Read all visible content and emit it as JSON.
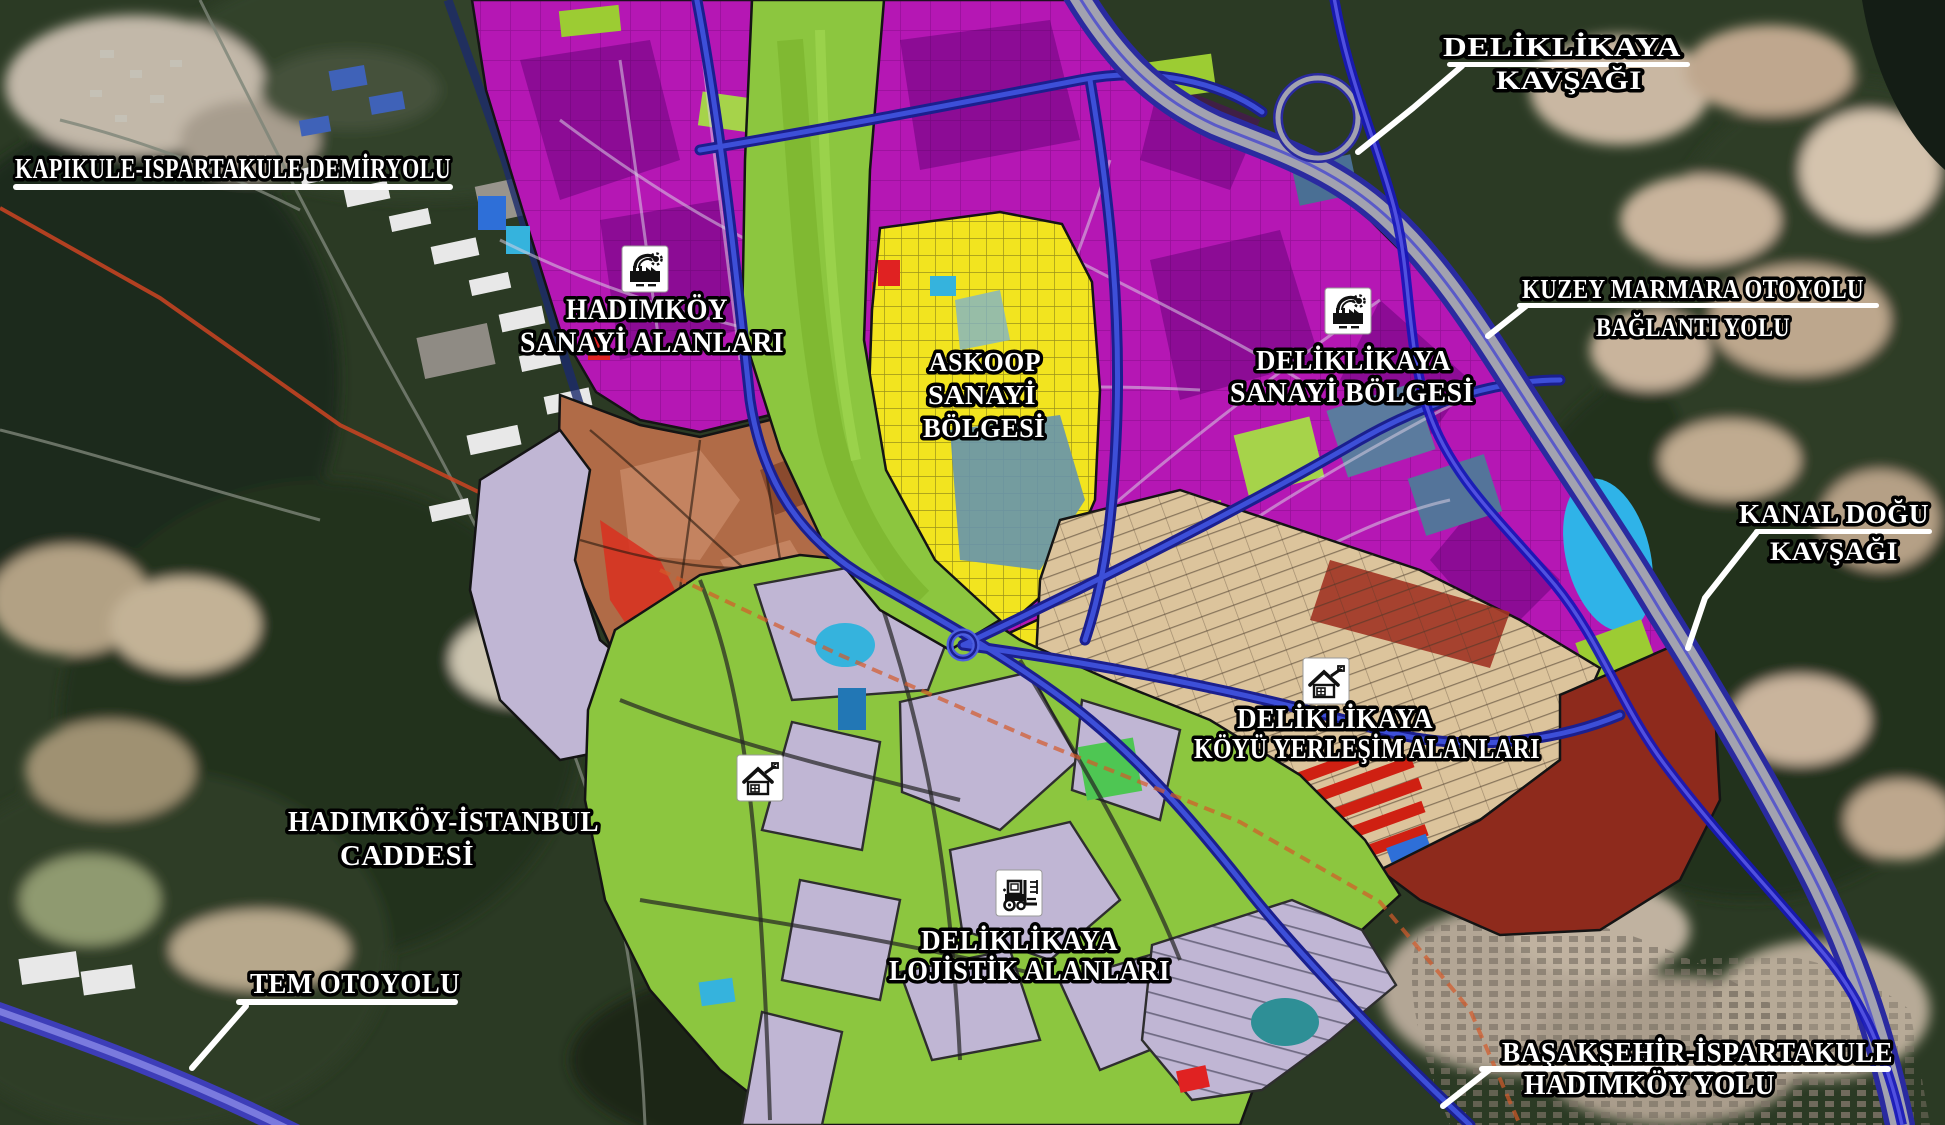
{
  "map_labels": {
    "demiryolu": {
      "line1": "KAPIKULE-ISPARTAKULE DEMİRYOLU"
    },
    "deliklikaya_kavsagi": {
      "line1": "DELİKLİKAYA",
      "line2": "KAVŞAĞI"
    },
    "kuzey_marmara": {
      "line1": "KUZEY MARMARA OTOYOLU",
      "line2": "BAĞLANTI YOLU"
    },
    "hadimkoy_sanayi": {
      "line1": "HADIMKÖY",
      "line2": "SANAYİ ALANLARI"
    },
    "askoop": {
      "line1": "ASKOOP",
      "line2": "SANAYİ",
      "line3": "BÖLGESİ"
    },
    "deliklikaya_sanayi": {
      "line1": "DELİKLİKAYA",
      "line2": "SANAYİ BÖLGESİ"
    },
    "kanal_dogu": {
      "line1": "KANAL DOĞU",
      "line2": "KAVŞAĞI"
    },
    "koyu_yerlesim": {
      "line1": "DELİKLİKAYA",
      "line2": "KÖYÜ YERLEŞİM ALANLARI"
    },
    "hadimkoy_istanbul": {
      "line1": "HADIMKÖY-İSTANBUL",
      "line2": "CADDESİ"
    },
    "tem": {
      "line1": "TEM OTOYOLU"
    },
    "lojistik": {
      "line1": "DELİKLİKAYA",
      "line2": "LOJİSTİK ALANLARI"
    },
    "basaksehir": {
      "line1": "BAŞAKŞEHİR-İSPARTAKULE",
      "line2": "HADIMKÖY YOLU"
    }
  },
  "icons": {
    "factory_industrial_zone": "factory-icon",
    "house_settlement_zone": "house-icon",
    "forklift_logistics_zone": "forklift-icon"
  },
  "colors": {
    "industrial_magenta": "#b517b4",
    "industrial_dark_patch": "#8a0f92",
    "askoop_yellow": "#f2e41f",
    "green_corridor": "#8cc63f",
    "logistics_lavender": "#c0b6d4",
    "residential_tan": "#dcc49c",
    "redbrick_zone": "#8e2a1c",
    "village_brown": "#b06b47",
    "red_parcel": "#e02222",
    "cyan_parcel": "#35b3dd",
    "steelblue_parcel": "#5b7b9e",
    "road_blue": "#2a35cc",
    "highway_grey": "#a2a2b0",
    "canal_blue": "#1717b8",
    "railway_red": "#cc4422",
    "label_fill": "#ffffff",
    "label_outline": "#000000",
    "icon_bg": "#ffffff",
    "icon_glyph": "#111111"
  }
}
